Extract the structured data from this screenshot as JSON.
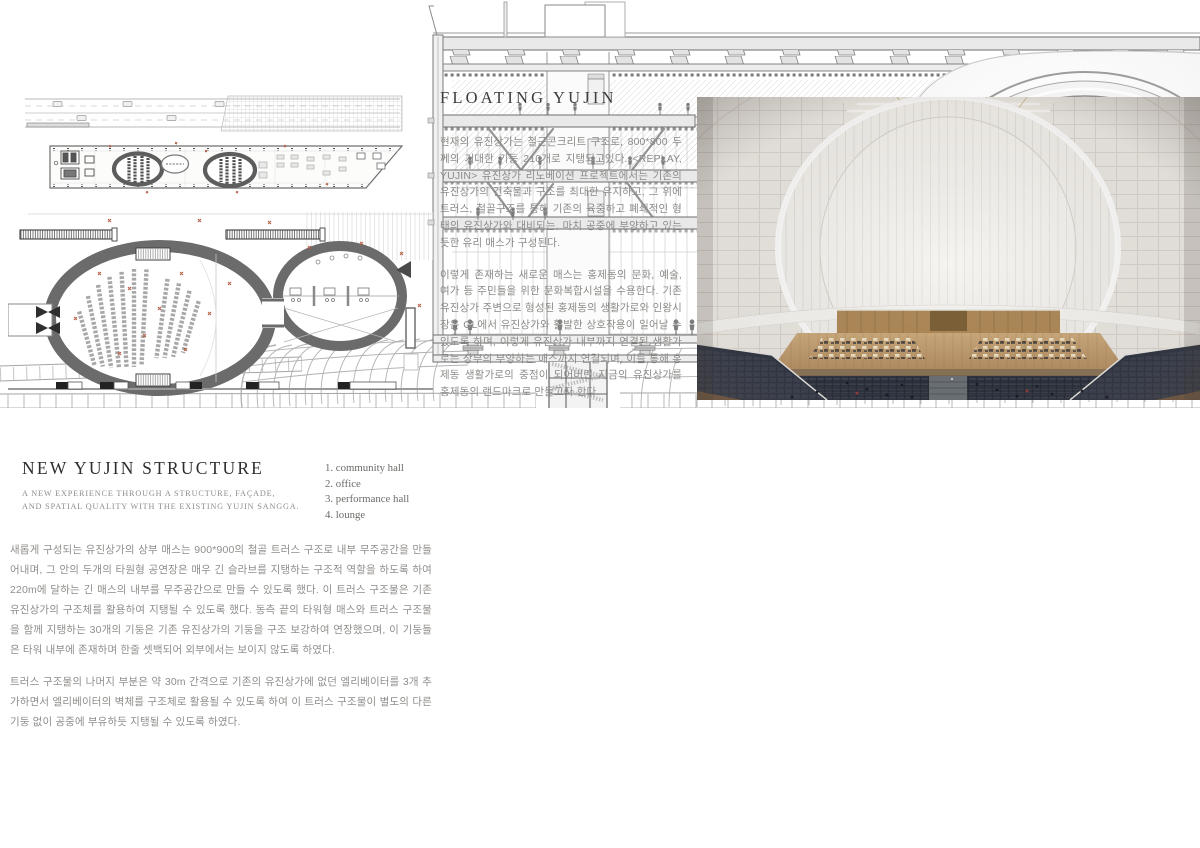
{
  "floating": {
    "title": "FLOATING YUJIN",
    "para1": "현재의 유진상가는 철근콘크리트 구조로, 800*800 두께의 거대한 기둥 210개로 지탱되고있다. <REPLAY, YUJIN> 유진상가 리노베이션 프로젝트에서는 기존의 유진상가의 건축물과 구조를 최대한 유지하고, 그 위에 트러스, 철골구조를 통해 기존의 육중하고 폐쇄적인 형태의 유진상가와 대비되는, 마치 공중에 부양하고 있는 듯한 유리 매스가 구성된다.",
    "para2": "이렇게 존재하는 새로운 매스는 홍제동의 문화, 예술, 여가 등 주민들을 위한 문화복합시설을 수용한다. 기존 유진상가 주변으로 형성된 홍제동의 생활가로와 인왕시장은 GL에서 유진상가와 활발한 상호작용이 일어날 수 있도록 하며, 이렇게 유진상가 내부까지 연결된 생활가로는 상부의 부양하는 매스까지 연결되며, 이를 통해 홍제동 생활가로의 중점이 되어버린 지금의 유진상가를 홍제동의 랜드마크로 만들고자 한다."
  },
  "structure": {
    "title": "NEW YUJIN STRUCTURE",
    "subtitle1": "A NEW EXPERIENCE THROUGH A STRUCTURE, FAÇADE,",
    "subtitle2": "AND SPATIAL QUALITY WITH THE EXISTING YUJIN SANGGA.",
    "legend": [
      "1. community hall",
      "2. office",
      "3. performance hall",
      "4. lounge"
    ],
    "para1": "새롭게 구성되는 유진상가의 상부 매스는 900*900의 철골 트러스 구조로 내부 무주공간을 만들어내며, 그 안의 두개의 타원형 공연장은 매우 긴 슬라브를 지탱하는 구조적 역할을 하도록 하여 220m에 달하는 긴 매스의 내부를 무주공간으로 만들 수 있도록 했다. 이 트러스 구조물은 기존 유진상가의 구조체를 활용하여 지탱될 수 있도록 했다. 동측 끝의 타워형 매스와 트러스 구조물을 함께 지탱하는 30개의 기둥은 기존 유진상가의 기둥을 구조 보강하여 연장했으며, 이 기둥들은 타워 내부에 존재하며 한줄 셋백되어 외부에서는 보이지 않도록 하였다.",
    "para2": "트러스 구조물의 나머지 부분은 약 30m 간격으로 기존의 유진상가에 없던 엘리베이터를 3개 추가하면서 엘리베이터의 벽체를 구조체로 활용될 수 있도록 하여 이 트러스 구조물이 별도의 다른 기둥 없이 공중에 부유하듯 지탱될 수 있도록 하였다."
  },
  "colors": {
    "accent_red": "#b25840",
    "plan_ring_gray": "#6b6b6b",
    "stage_wood": "#c3a37a",
    "audience_navy": "#2c3340",
    "oval_stage_yellow": "#b9a82e"
  }
}
